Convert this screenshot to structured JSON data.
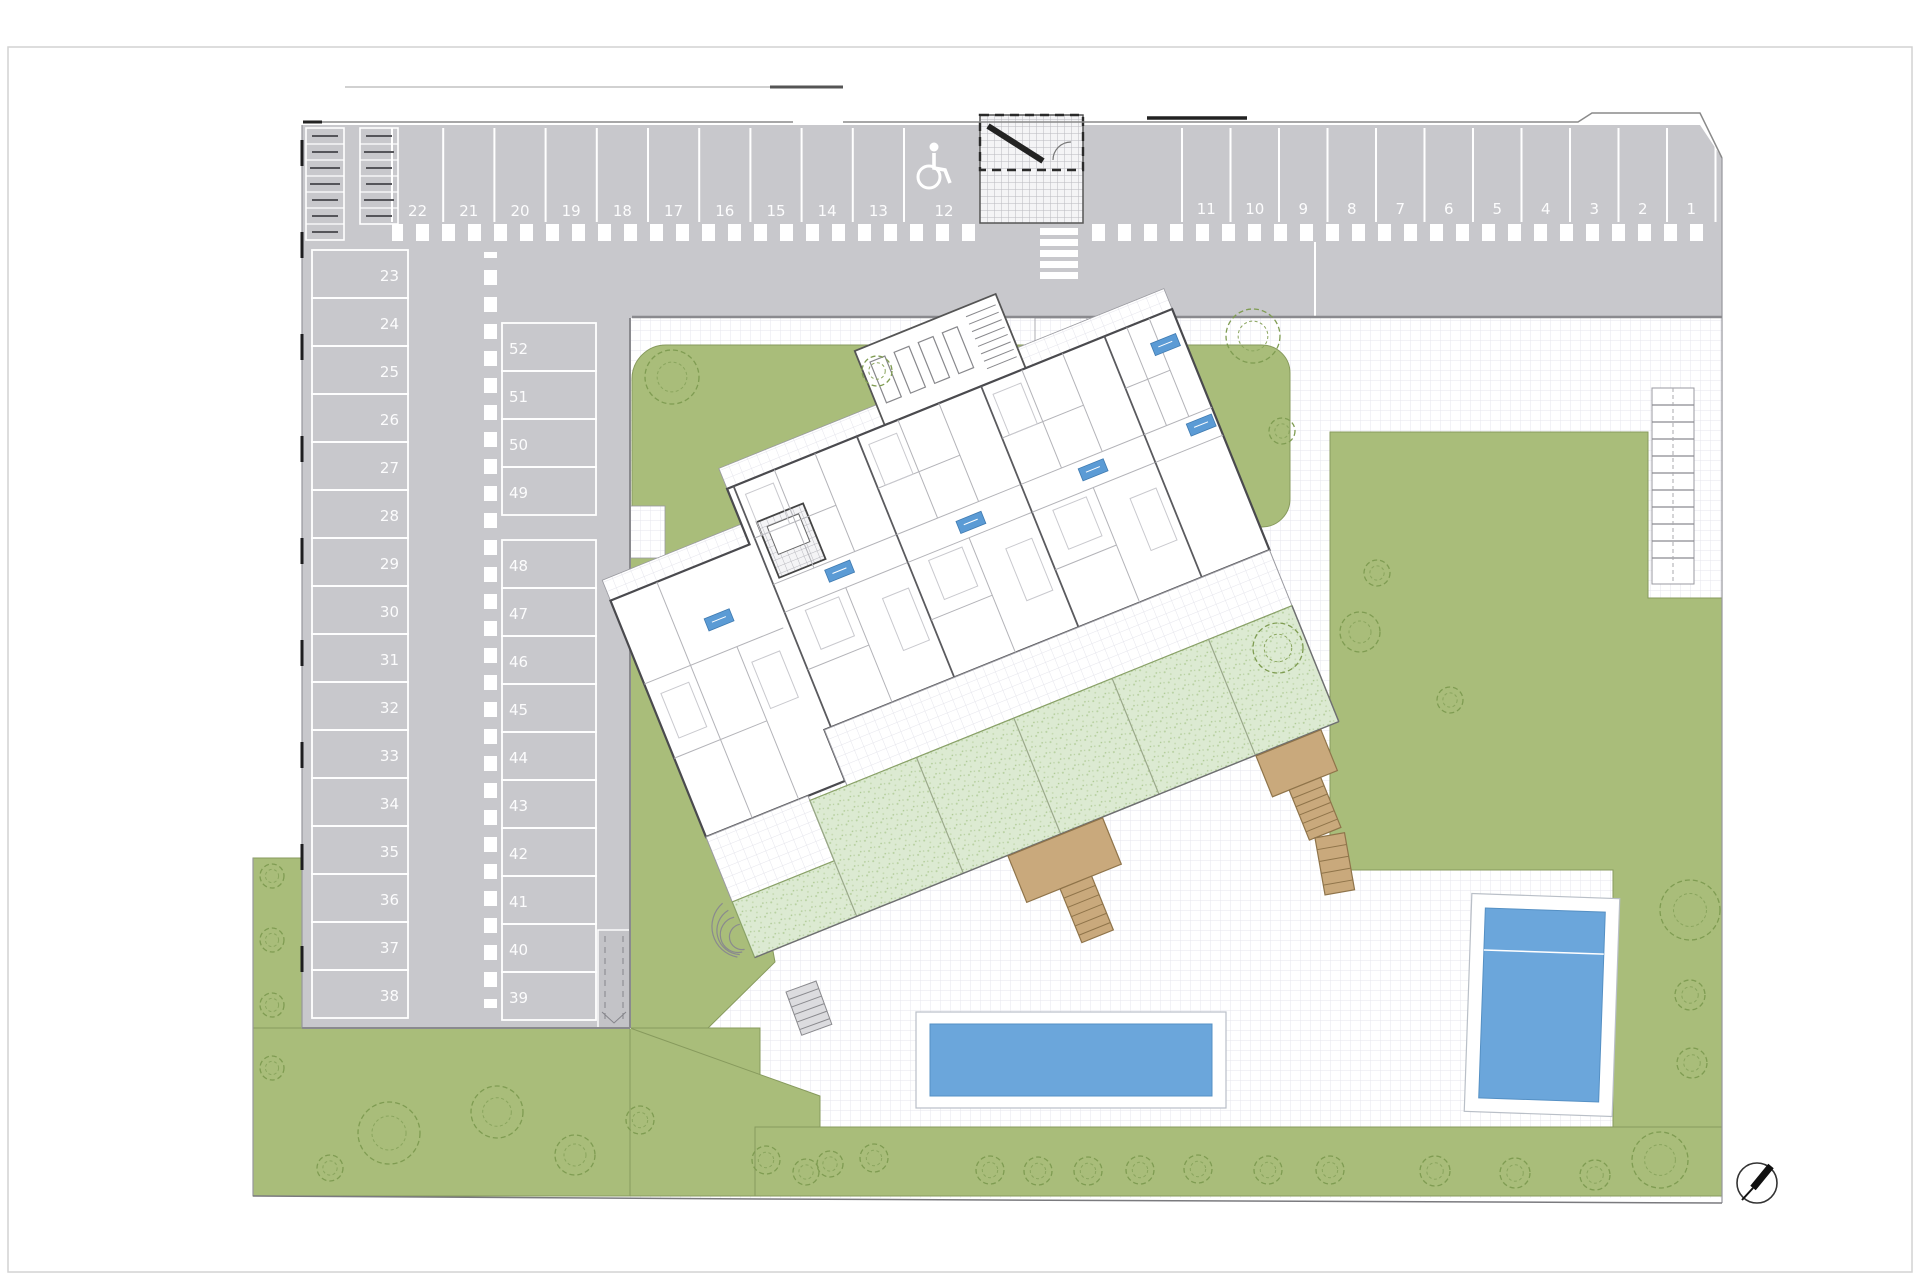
{
  "site_plan": {
    "type": "residential-site-plan",
    "parking": {
      "top_row_left": [
        "22",
        "21",
        "20",
        "19",
        "18",
        "17",
        "16",
        "15",
        "14",
        "13",
        "12"
      ],
      "top_row_right": [
        "11",
        "10",
        "9",
        "8",
        "7",
        "6",
        "5",
        "4",
        "3",
        "2",
        "1"
      ],
      "left_column": [
        "23",
        "24",
        "25",
        "26",
        "27",
        "28",
        "29",
        "30",
        "31",
        "32",
        "33",
        "34",
        "35",
        "36",
        "37",
        "38"
      ],
      "middle_column": [
        "52",
        "51",
        "50",
        "49",
        "48",
        "47",
        "46",
        "45",
        "44",
        "43",
        "42",
        "41",
        "40",
        "39"
      ],
      "accessible_space": "12"
    },
    "icons": {
      "accessible_parking": "wheelchair-icon",
      "north_arrow": "north-arrow-icon",
      "trees": "tree-canopy-icon",
      "bike_racks": "cycle-rack-icon"
    },
    "colors": {
      "asphalt": "#c8c8cc",
      "lawn": "#a9bd7a",
      "private_garden": "#dcead2",
      "pool_water": "#6ba6db",
      "stair_tan": "#c9a97c",
      "unit_chip_blue": "#5b9bd5"
    }
  }
}
